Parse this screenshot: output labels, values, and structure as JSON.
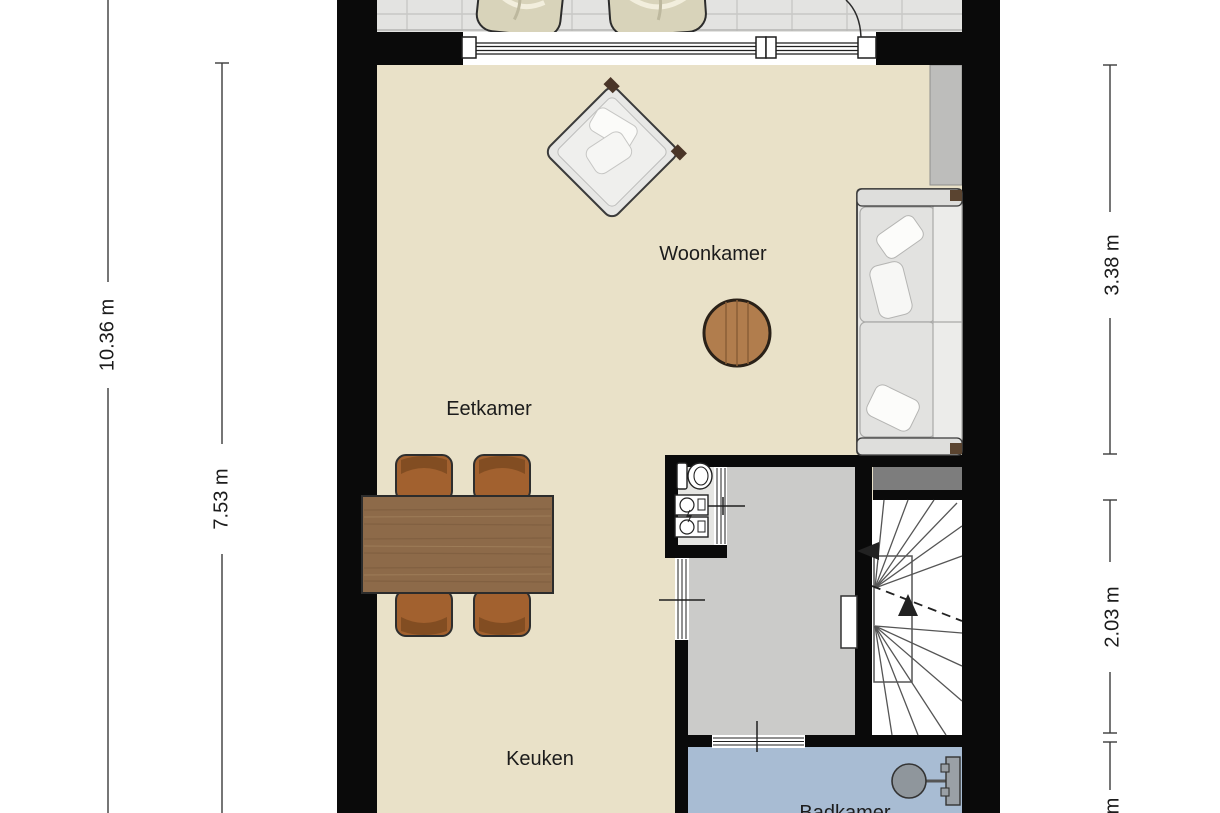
{
  "plan": {
    "type": "floorplan",
    "language": "nl"
  },
  "rooms": {
    "woonkamer": "Woonkamer",
    "eetkamer": "Eetkamer",
    "keuken": "Keuken",
    "badkamer": "Badkamer"
  },
  "dimensions": {
    "left_total": "10.36 m",
    "left_inner": "7.53 m",
    "right_living": "3.38 m",
    "right_hall": "2.03 m",
    "right_partial": "m"
  },
  "fixtures": [
    "balcony-lounge-chair",
    "balcony-lounge-chair",
    "armchair",
    "round-side-table",
    "sofa",
    "dining-table",
    "dining-chair",
    "dining-chair",
    "dining-chair",
    "dining-chair",
    "toilet",
    "washer-unit",
    "winder-staircase",
    "wall-basin"
  ],
  "colors": {
    "wall": "#0a0a0a",
    "floor_living": "#e9e1c8",
    "floor_hall": "#cbcbc9",
    "floor_closet": "#e6e6e3",
    "floor_bath": "#a8bcd3",
    "balcony_tile": "#e3e3e1",
    "wood_table": "#8d6a49",
    "wood_chair": "#a2612f",
    "sofa": "#e6e6e4",
    "stair_bar": "#7d7d7d",
    "shaft": "#bdbdbb",
    "dim_line": "#3c3c3c",
    "text": "#1c1c1c"
  }
}
